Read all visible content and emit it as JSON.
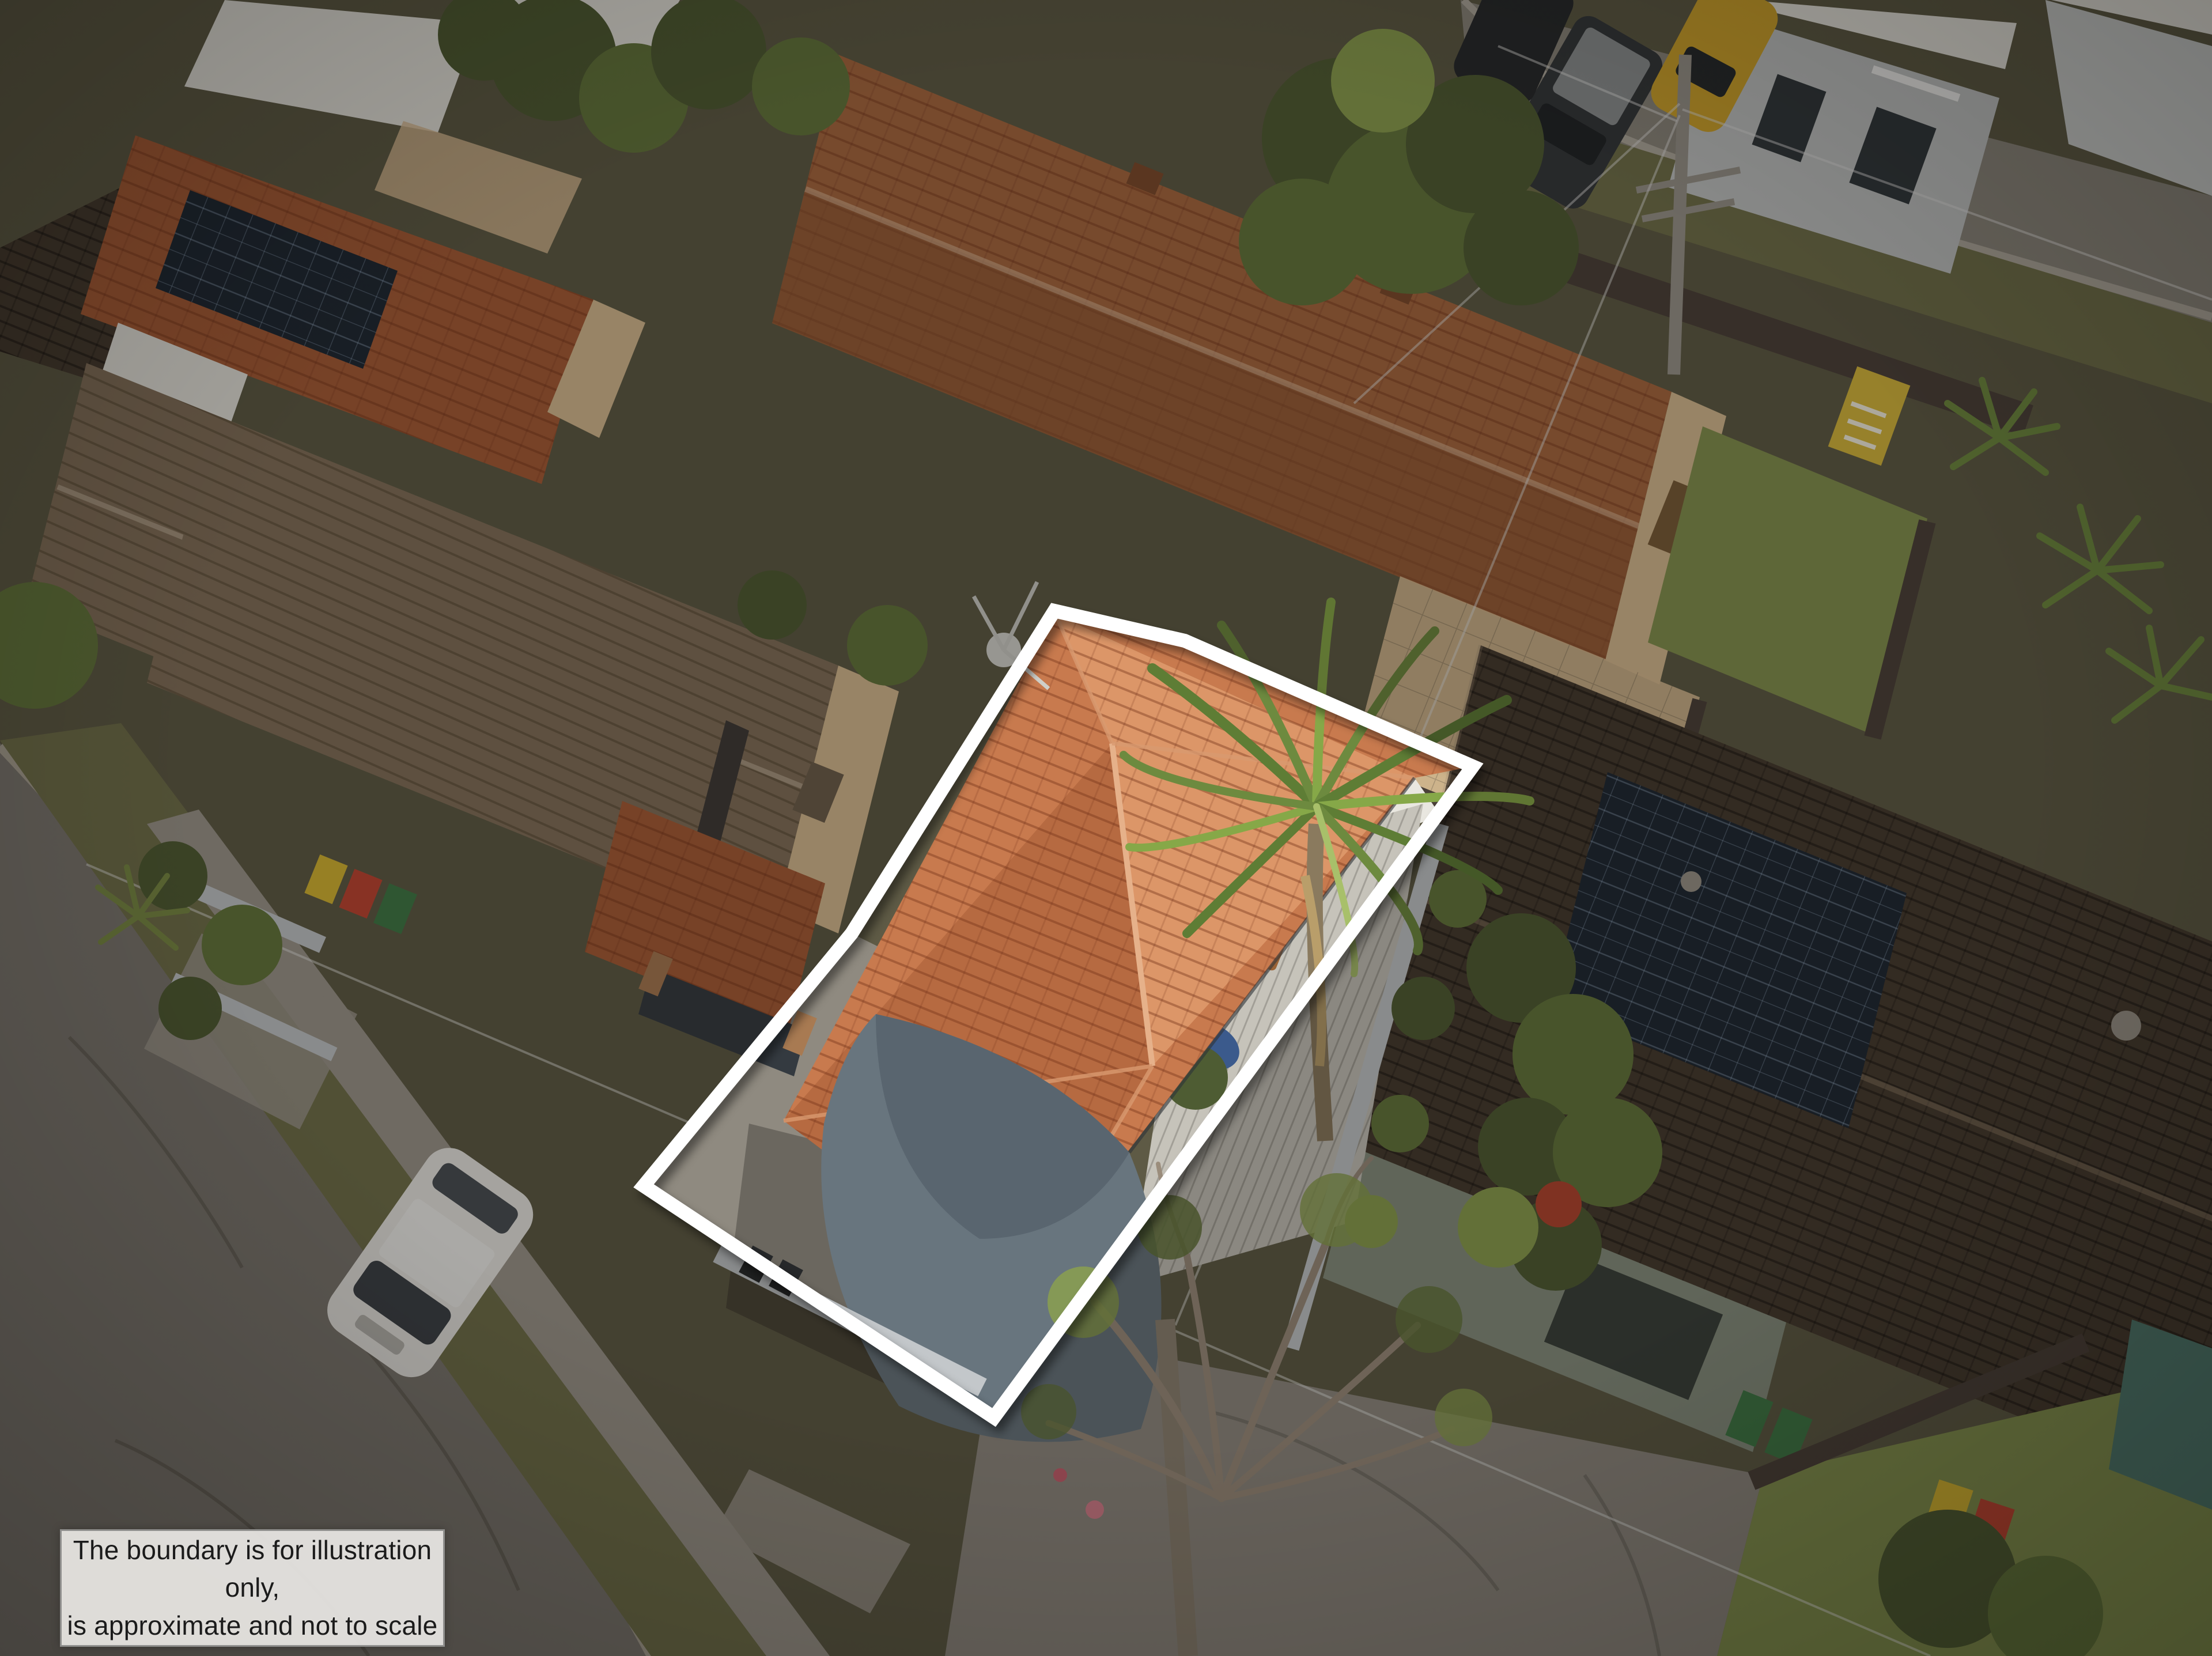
{
  "disclaimer": {
    "line1": "The boundary is for illustration only,",
    "line2": "is approximate and not to scale"
  },
  "boundary": {
    "color": "#ffffff",
    "stroke_width": 24,
    "points": [
      [
        1830,
        1060
      ],
      [
        2056,
        1112
      ],
      [
        2556,
        1330
      ],
      [
        1725,
        2460
      ],
      [
        1117,
        2058
      ],
      [
        1478,
        1620
      ]
    ]
  },
  "overlay": {
    "dim_color": "rgba(16,13,9,0.32)",
    "vignette_strength": 0.22
  },
  "palette": {
    "ground": "#5e5a45",
    "road": "#7d7870",
    "road-light": "#8d887e",
    "grass-dim": "#71714a",
    "grass-bright": "#84934e",
    "concrete": "#8f8a80",
    "concrete-light": "#9c978c",
    "roof-terracotta": "#c87a4e",
    "roof-terracotta-light": "#dc9668",
    "roof-terracotta-dark": "#a85c36",
    "roof-brown-left": "#83715a",
    "roof-rear": "#a8683f",
    "roof-rear-dark": "#8e5531",
    "roof-dark": "#453a2e",
    "solar": "#1d2733",
    "brick-tan": "#d9bd92",
    "deck": "#c6c3ba",
    "sail": "#68757e",
    "sail-dark": "#55626b",
    "white-struct": "#e9e7e0",
    "tree-dark": "#4e5c33",
    "tree-mid": "#64763c",
    "tree-light": "#8ba04f",
    "fence-silver": "#c3c7ca",
    "fence-dark": "#4a4038",
    "wire": "#e4e4e2",
    "trunk": "#8a7a5e",
    "car-white": "#eceae6",
    "bin-green": "#3f7a46",
    "bin-yellow": "#d8b732",
    "bin-red": "#c24532",
    "sign-yellow": "#d8b93c",
    "disclaimer-bg": "rgba(233,231,228,0.93)",
    "disclaimer-border": "#8f8f8d",
    "disclaimer-text": "#1b1b1b"
  }
}
